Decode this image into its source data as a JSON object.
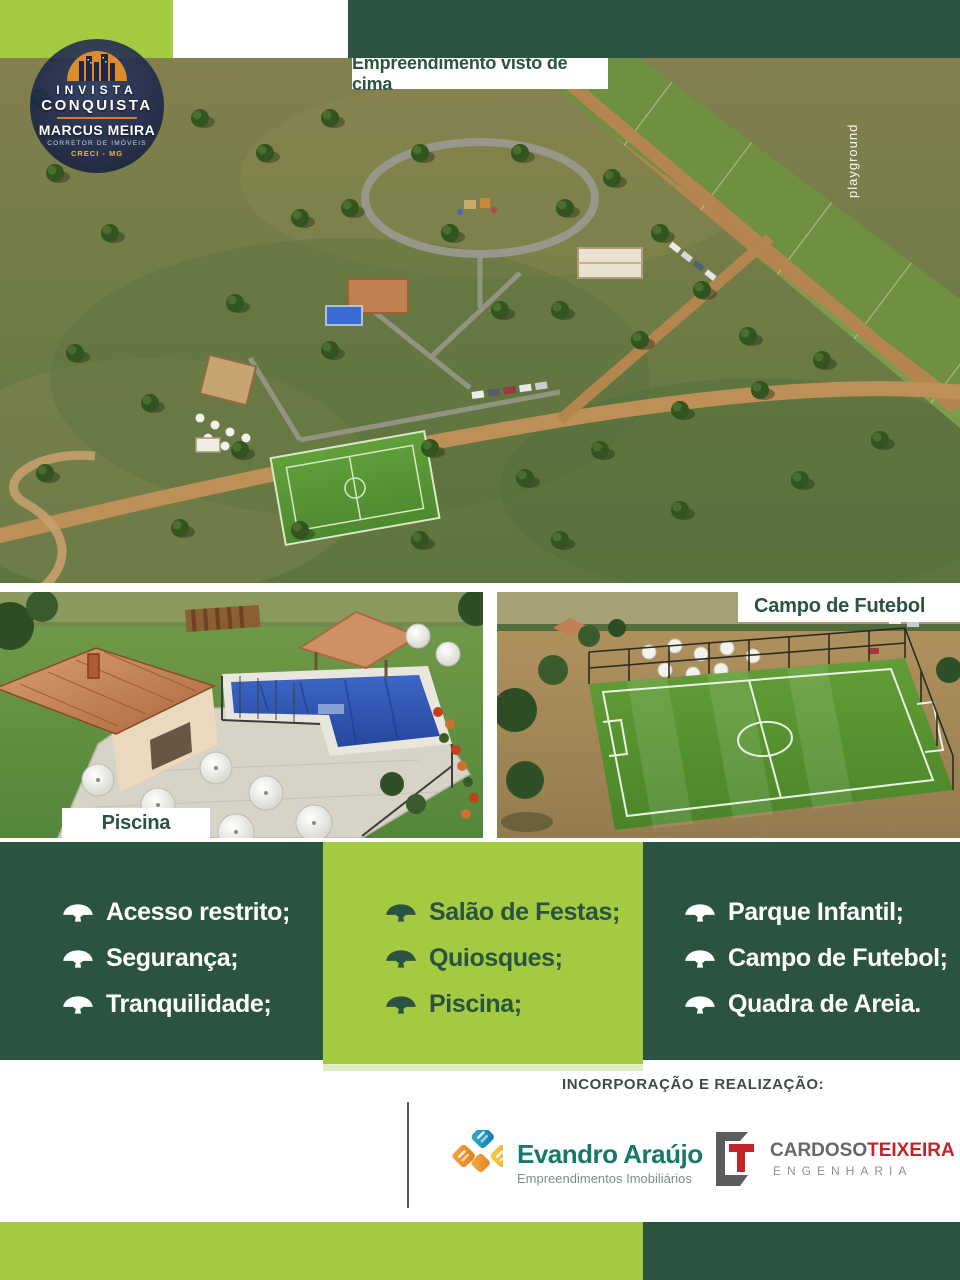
{
  "badge": {
    "top_line": "INVISTA",
    "bottom_line": "CONQUISTA",
    "name": "MARCUS MEIRA",
    "role": "CORRETOR DE IMÓVEIS",
    "creci": "CRECI - MG"
  },
  "top_image": {
    "caption": "Empreendimento visto de cima",
    "annotation": "playground"
  },
  "gallery": [
    {
      "caption": "Piscina"
    },
    {
      "caption": "Campo de Futebol"
    }
  ],
  "features": {
    "columns": [
      {
        "items": [
          "Acesso restrito;",
          "Segurança;",
          "Tranquilidade;"
        ]
      },
      {
        "items": [
          "Salão de Festas;",
          "Quiosques;",
          "Piscina;"
        ]
      },
      {
        "items": [
          "Parque Infantil;",
          "Campo de Futebol;",
          "Quadra de Areia."
        ]
      }
    ]
  },
  "footer": {
    "heading": "INCORPORAÇÃO E REALIZAÇÃO:",
    "brands": [
      {
        "name": "Evandro Araújo",
        "subtitle": "Empreendimentos Imobiliários"
      },
      {
        "name_gray": "CARDOSO",
        "name_red": "TEIXEIRA",
        "subtitle": "ENGENHARIA"
      }
    ]
  },
  "colors": {
    "dark_green": "#2b5440",
    "light_green": "#a3ca41",
    "brand_teal": "#17796a",
    "brand_red": "#c4232a",
    "badge_orange": "#dd8c2c"
  }
}
